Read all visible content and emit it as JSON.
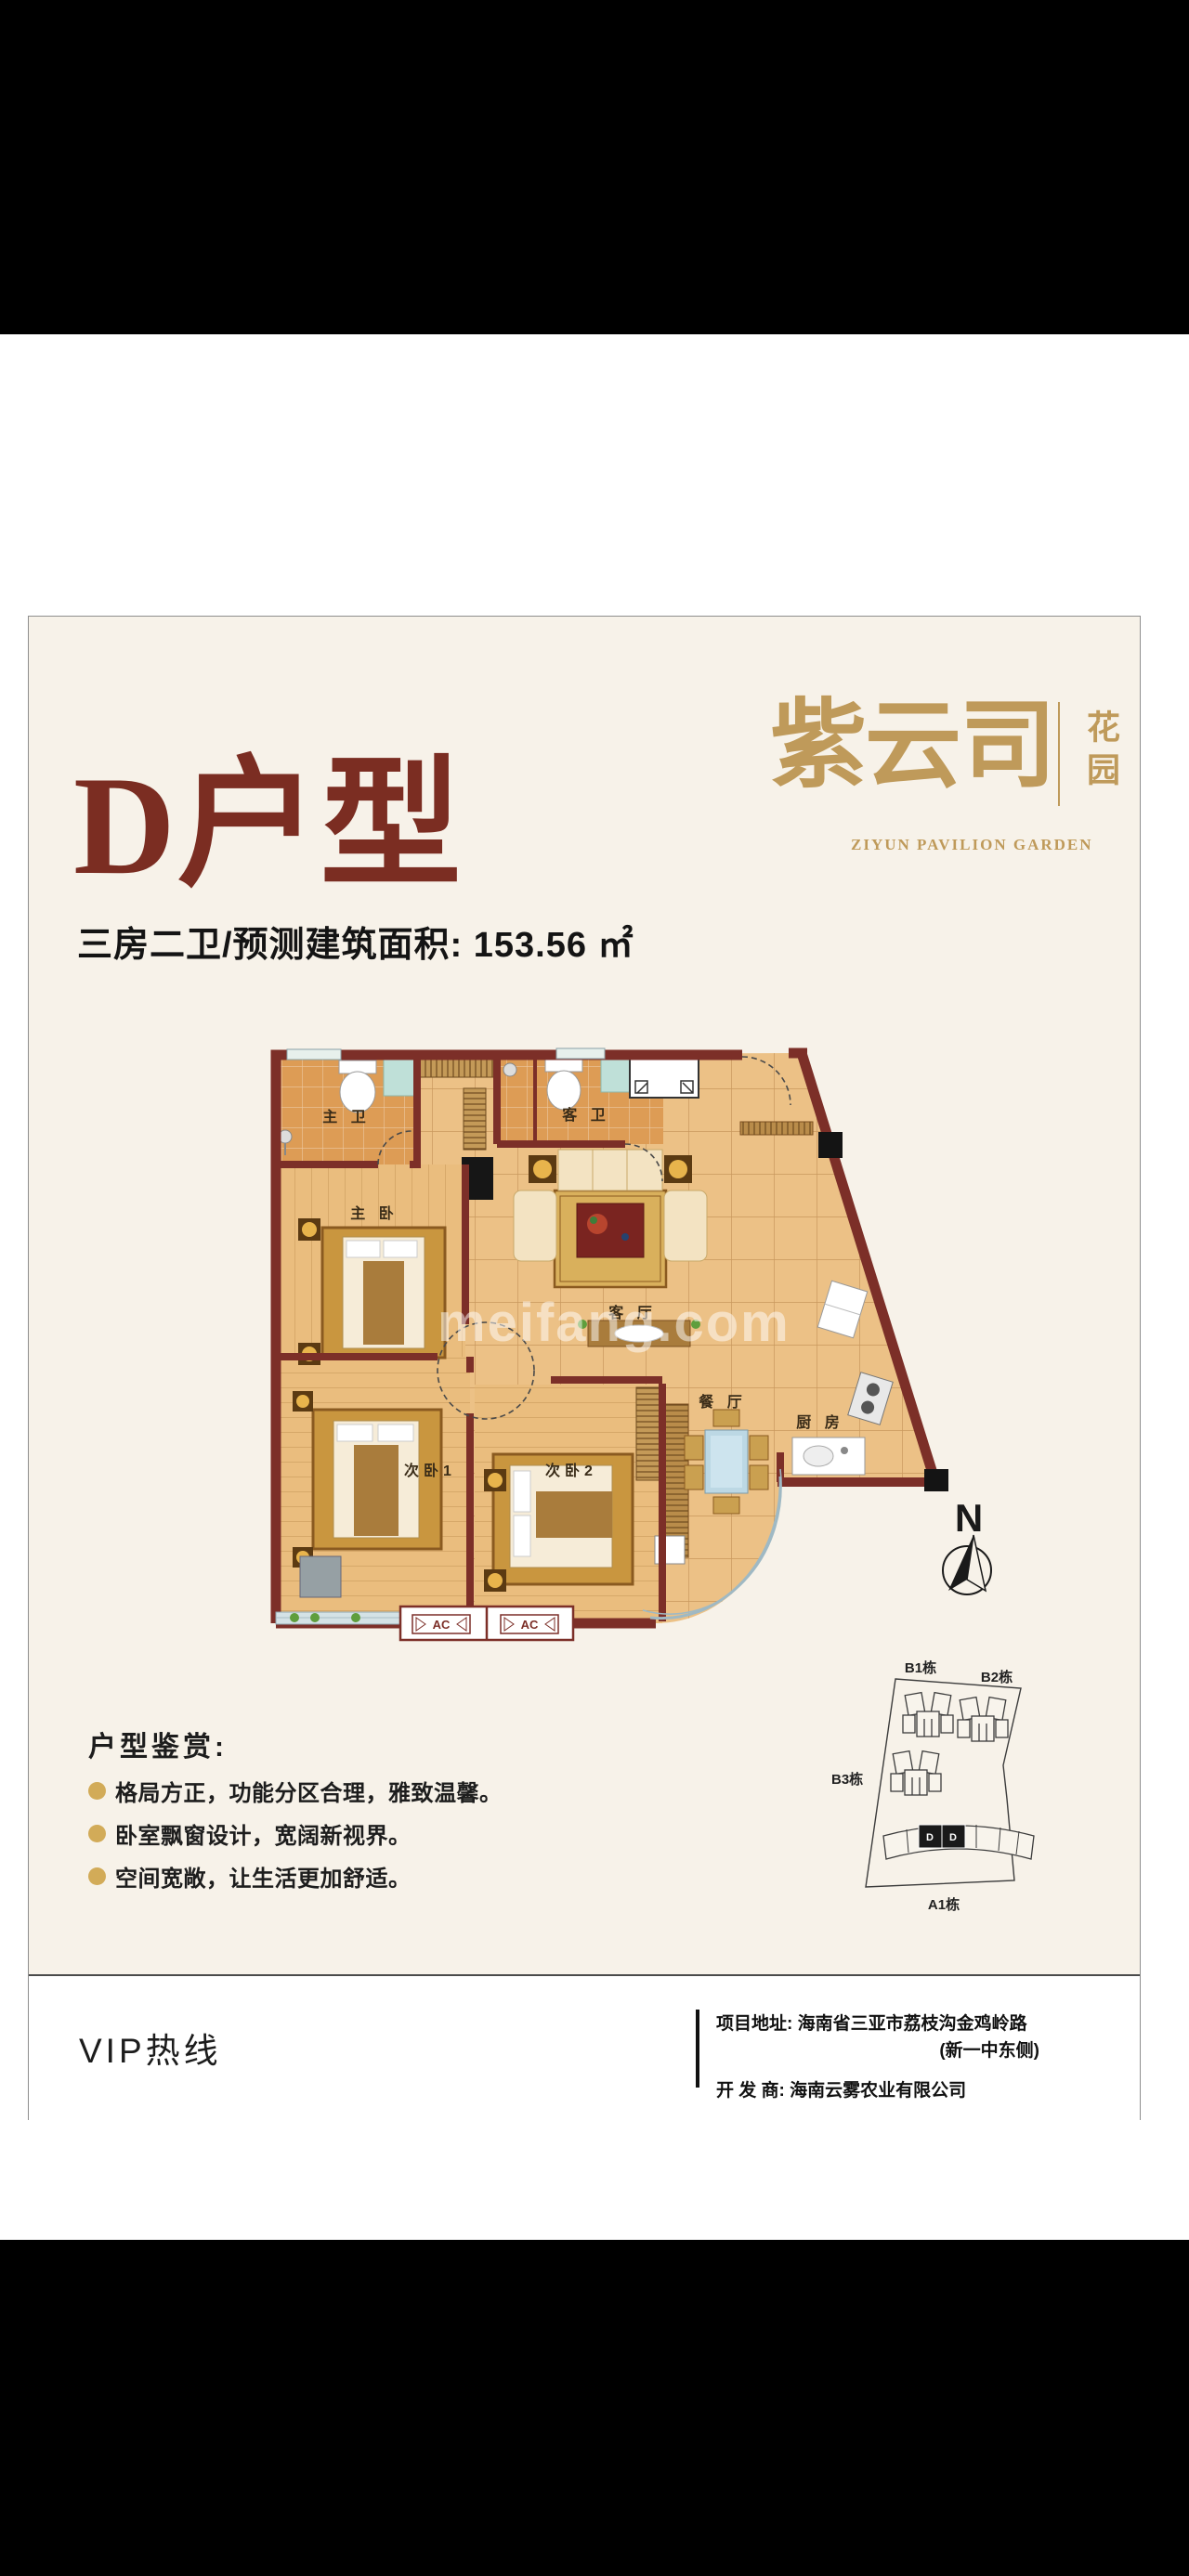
{
  "logo": {
    "brand": "紫云司",
    "suffix_vertical": "花园",
    "english": "ZIYUN PAVILION GARDEN",
    "gold_color": "#bf9a5a"
  },
  "header": {
    "title": "D户型",
    "title_color": "#7b2d22",
    "subtitle": "三房二卫/预测建筑面积: 153.56 ㎡"
  },
  "floorplan": {
    "watermark": "meifang.com",
    "wall_color": "#7c2f28",
    "floor_color": "#ecc186",
    "rooms": {
      "master_bath": "主 卫",
      "guest_bath": "客 卫",
      "master_bedroom": "主 卧",
      "bedroom1": "次卧1",
      "bedroom2": "次卧2",
      "living": "客 厅",
      "dining": "餐 厅",
      "kitchen": "厨 房"
    },
    "ac_label": "AC"
  },
  "compass": {
    "label": "N"
  },
  "siteplan": {
    "b1": "B1栋",
    "b2": "B2栋",
    "b3": "B3栋",
    "a1": "A1栋",
    "unit": "D"
  },
  "features": {
    "heading": "户型鉴赏:",
    "items": [
      {
        "text": "格局方正，功能分区合理，雅致温馨。"
      },
      {
        "text": "卧室飘窗设计，宽阔新视界。"
      },
      {
        "text": "空间宽敞，让生活更加舒适。"
      }
    ]
  },
  "footer": {
    "vip": "VIP热线",
    "address_line1": "项目地址: 海南省三亚市荔枝沟金鸡岭路",
    "address_line2": "(新一中东侧)",
    "developer": "开 发 商: 海南云雾农业有限公司"
  }
}
